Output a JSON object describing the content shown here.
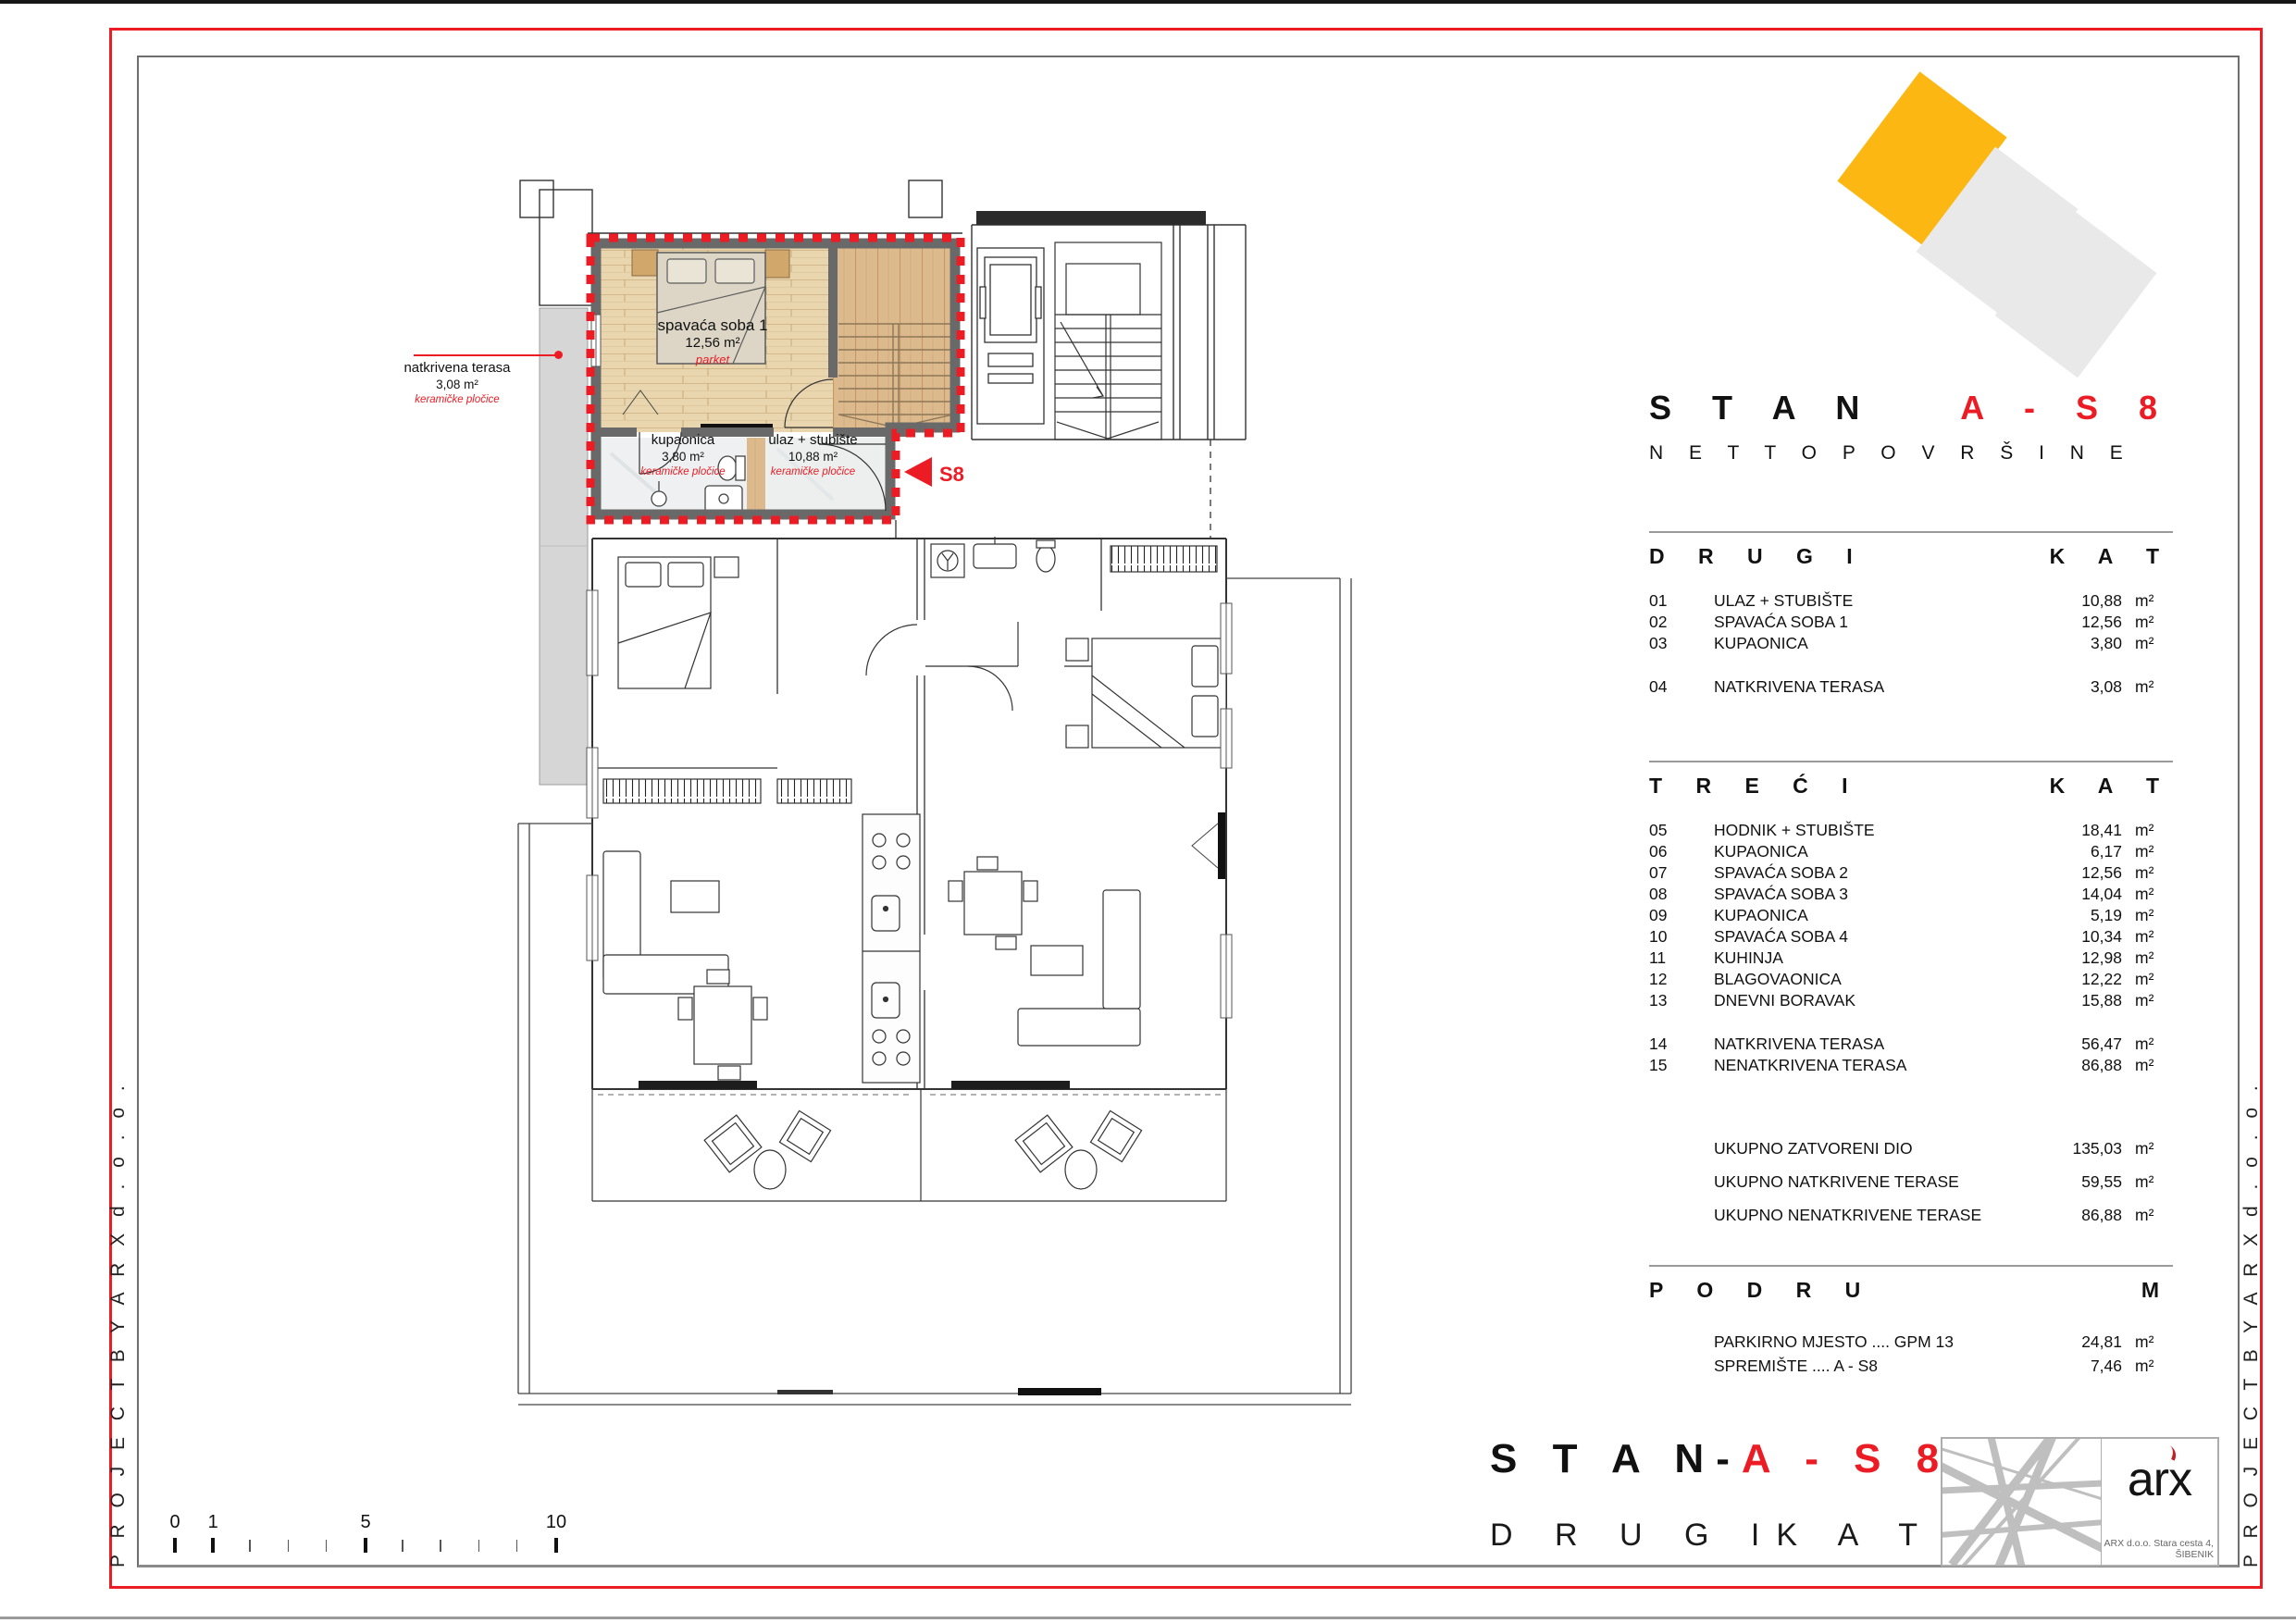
{
  "side_text": "P R O J E C T   B Y   A R X   d . o . o .",
  "colors": {
    "accent_red": "#ec1c24",
    "logo_yellow": "#fcb713",
    "logo_gray": "#e9e9e9",
    "unit_wall_gray": "#696969"
  },
  "plan": {
    "terrace_label": {
      "title": "natkrivena terasa",
      "area": "3,08 m²",
      "finish": "keramičke pločice"
    },
    "bedroom_label": {
      "title": "spavaća soba 1",
      "area": "12,56 m²",
      "finish": "parket"
    },
    "bathroom_label": {
      "title": "kupaonica",
      "area": "3,80 m²",
      "finish": "keramičke pločice"
    },
    "entry_label": {
      "title": "ulaz + stubište",
      "area": "10,88 m²",
      "finish": "keramičke pločice"
    },
    "marker": "S8"
  },
  "panel": {
    "title_black": "S T A N",
    "title_red": "A - S 8",
    "subtitle": "N E T T O   P O V R Š I N E",
    "sections": [
      {
        "header_left": "D R U G I",
        "header_right": "K A T",
        "rows": [
          {
            "num": "01",
            "label": "ULAZ + STUBIŠTE",
            "value": "10,88",
            "unit": "m²",
            "gap_before": false
          },
          {
            "num": "02",
            "label": "SPAVAĆA SOBA 1",
            "value": "12,56",
            "unit": "m²",
            "gap_before": false
          },
          {
            "num": "03",
            "label": "KUPAONICA",
            "value": "3,80",
            "unit": "m²",
            "gap_before": false
          },
          {
            "num": "04",
            "label": "NATKRIVENA TERASA",
            "value": "3,08",
            "unit": "m²",
            "gap_before": true
          }
        ]
      },
      {
        "header_left": "T R E Ć I",
        "header_right": "K A T",
        "rows": [
          {
            "num": "05",
            "label": "HODNIK + STUBIŠTE",
            "value": "18,41",
            "unit": "m²",
            "gap_before": false
          },
          {
            "num": "06",
            "label": "KUPAONICA",
            "value": "6,17",
            "unit": "m²",
            "gap_before": false
          },
          {
            "num": "07",
            "label": "SPAVAĆA SOBA 2",
            "value": "12,56",
            "unit": "m²",
            "gap_before": false
          },
          {
            "num": "08",
            "label": "SPAVAĆA SOBA 3",
            "value": "14,04",
            "unit": "m²",
            "gap_before": false
          },
          {
            "num": "09",
            "label": "KUPAONICA",
            "value": "5,19",
            "unit": "m²",
            "gap_before": false
          },
          {
            "num": "10",
            "label": "SPAVAĆA SOBA 4",
            "value": "10,34",
            "unit": "m²",
            "gap_before": false
          },
          {
            "num": "11",
            "label": "KUHINJA",
            "value": "12,98",
            "unit": "m²",
            "gap_before": false
          },
          {
            "num": "12",
            "label": "BLAGOVAONICA",
            "value": "12,22",
            "unit": "m²",
            "gap_before": false
          },
          {
            "num": "13",
            "label": "DNEVNI BORAVAK",
            "value": "15,88",
            "unit": "m²",
            "gap_before": false
          },
          {
            "num": "14",
            "label": "NATKRIVENA TERASA",
            "value": "56,47",
            "unit": "m²",
            "gap_before": true
          },
          {
            "num": "15",
            "label": "NENATKRIVENA TERASA",
            "value": "86,88",
            "unit": "m²",
            "gap_before": false
          }
        ]
      }
    ],
    "totals": [
      {
        "label": "UKUPNO ZATVORENI DIO",
        "value": "135,03",
        "unit": "m²"
      },
      {
        "label": "UKUPNO NATKRIVENE TERASE",
        "value": "59,55",
        "unit": "m²"
      },
      {
        "label": "UKUPNO NENATKRIVENE TERASE",
        "value": "86,88",
        "unit": "m²"
      }
    ],
    "podrum": {
      "header_left": "P O D R U",
      "header_right": "M",
      "rows": [
        {
          "label": "PARKIRNO MJESTO .... GPM 13",
          "value": "24,81",
          "unit": "m²"
        },
        {
          "label": "SPREMIŠTE .... A - S8",
          "value": "7,46",
          "unit": "m²"
        }
      ]
    }
  },
  "titleblock": {
    "title_black": "S T A N",
    "dash": "-",
    "title_red": "A - S 8",
    "floor_left": "D R U G I",
    "floor_right": "K A T",
    "logo_text": "arx",
    "address": "ARX d.o.o. Stara cesta 4, ŠIBENIK"
  },
  "scalebar": {
    "max": 10,
    "major": [
      0,
      1,
      5,
      10
    ],
    "labels": {
      "0": "0",
      "1": "1",
      "5": "5",
      "10": "10"
    }
  }
}
